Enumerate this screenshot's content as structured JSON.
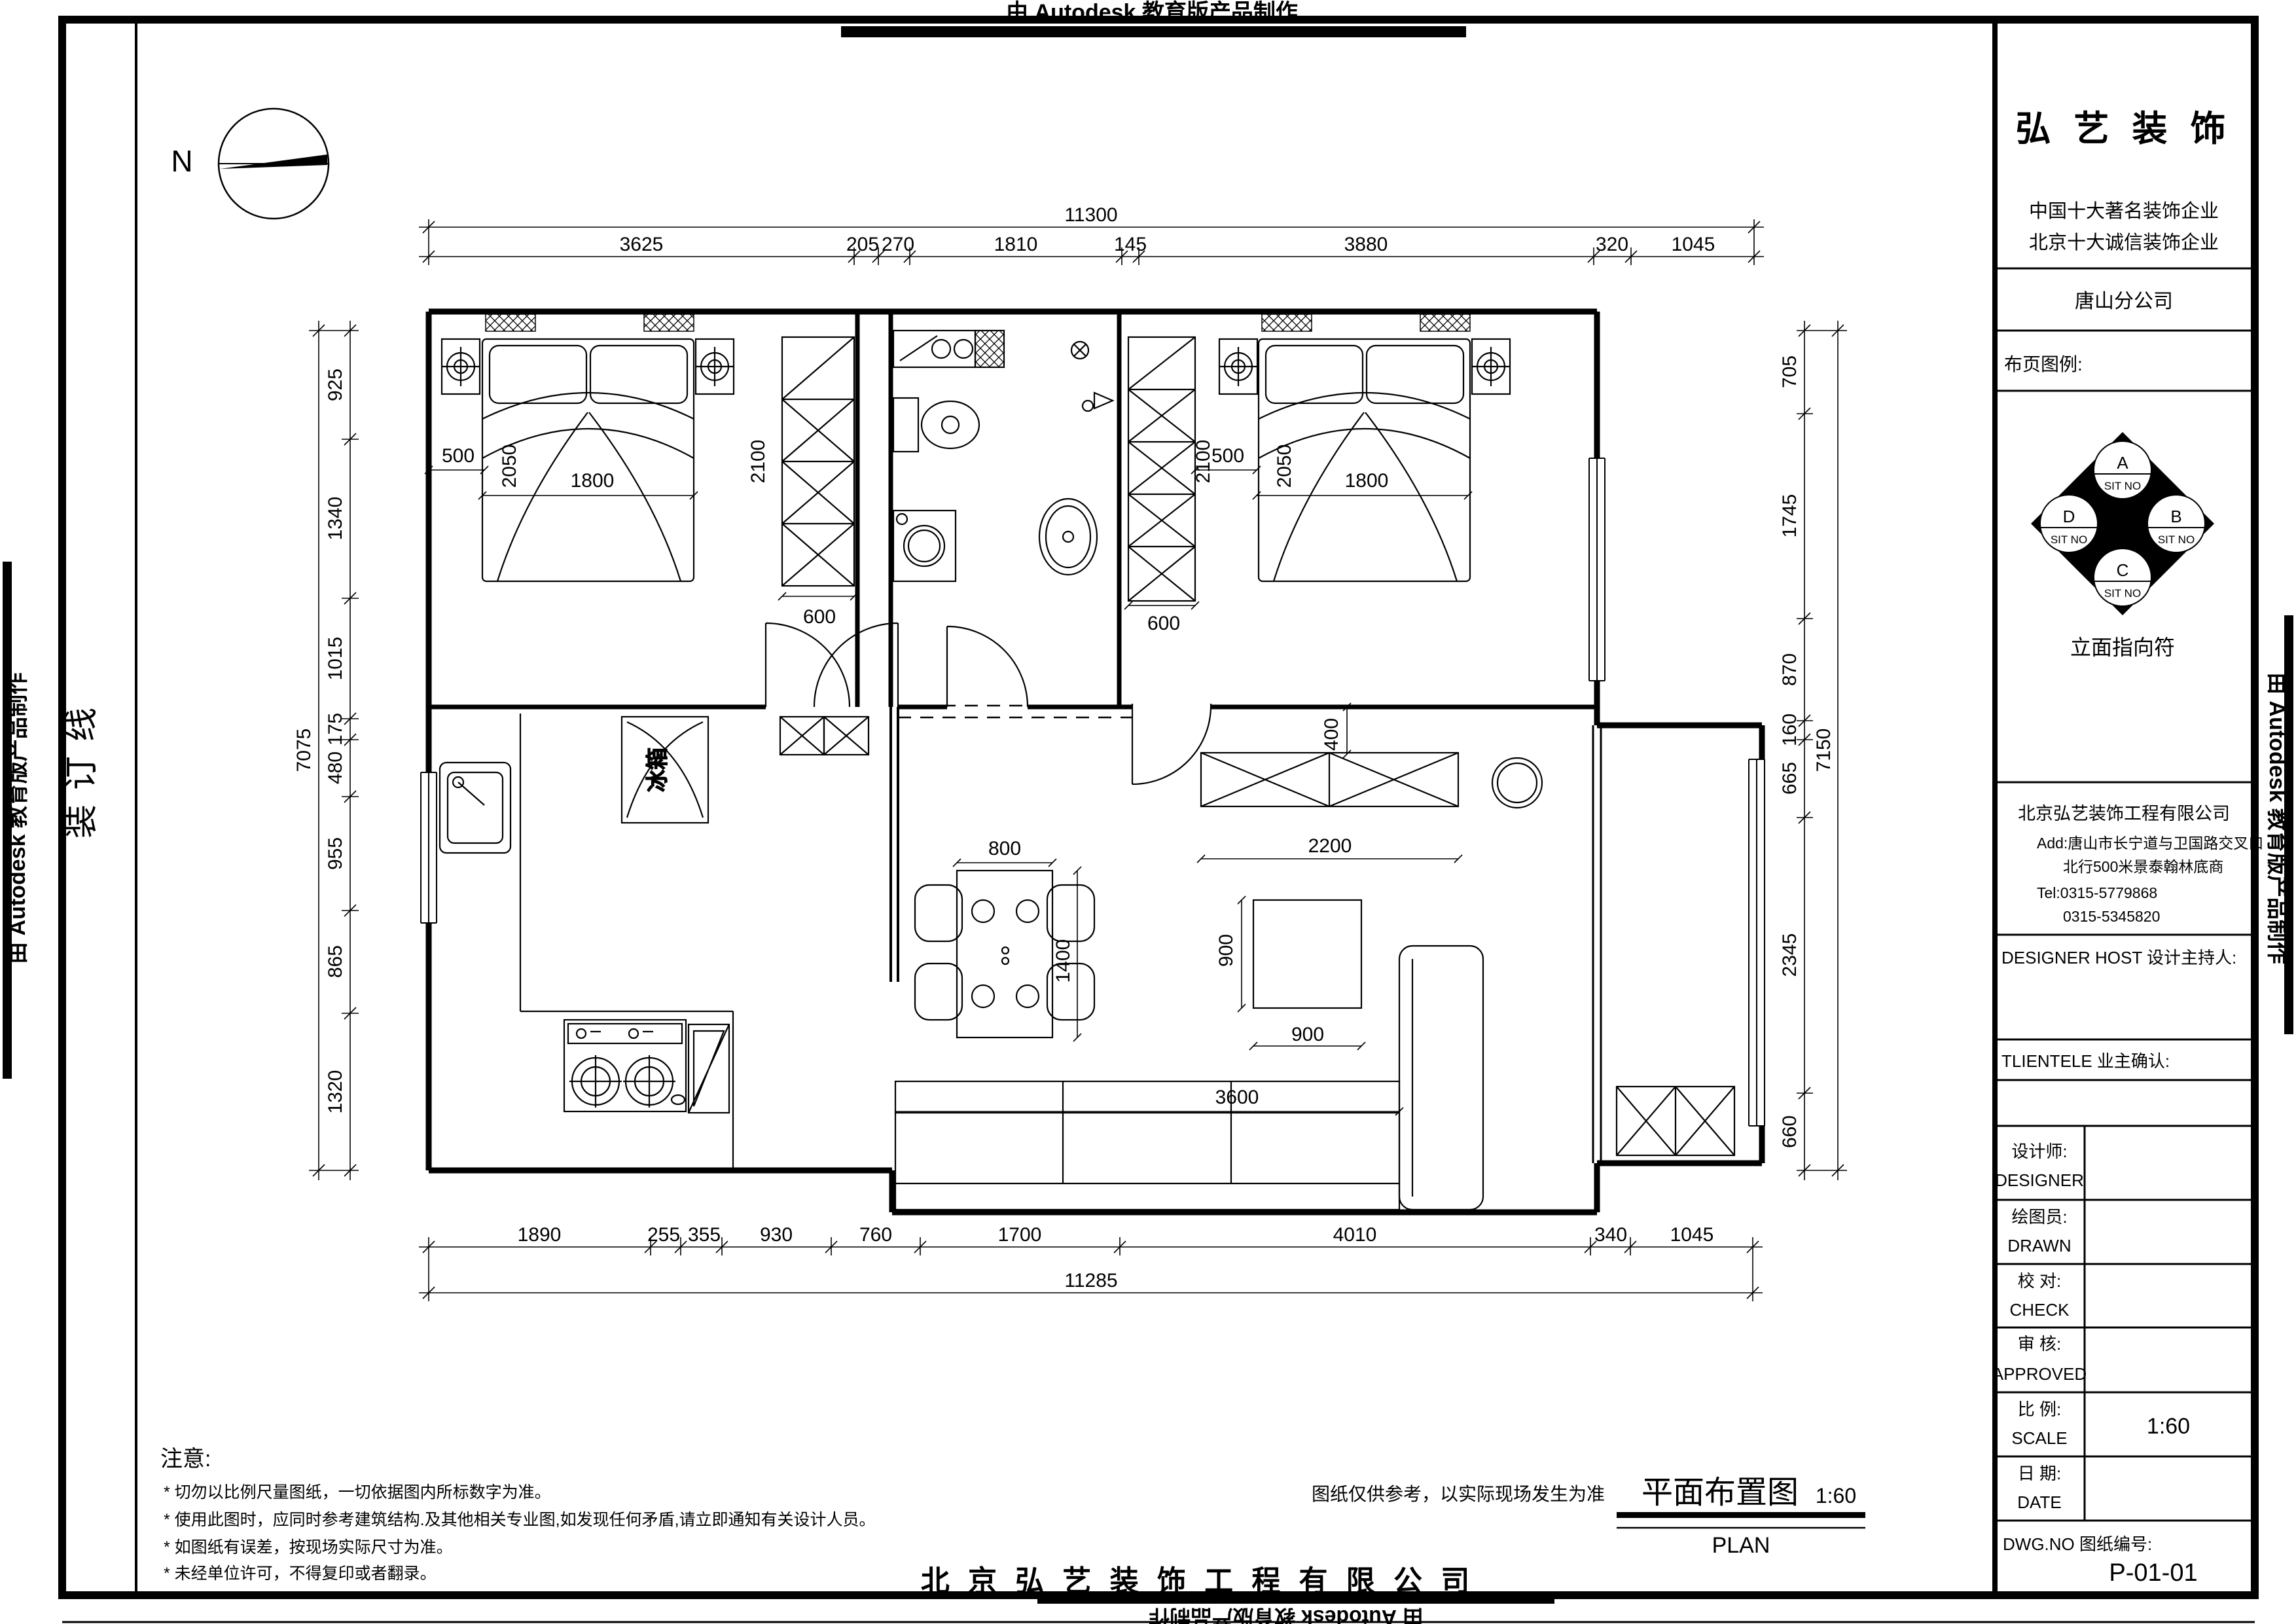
{
  "banner": {
    "text": "由 Autodesk 教育版产品制作"
  },
  "margins": {
    "binding_line": "装订线"
  },
  "compass": {
    "north": "N"
  },
  "title_block": {
    "logo": "弘 艺 装 饰",
    "slogan1": "中国十大著名装饰企业",
    "slogan2": "北京十大诚信装饰企业",
    "branch": "唐山分公司",
    "legend_label": "布页图例:",
    "legend": {
      "a": "A",
      "b": "B",
      "c": "C",
      "d": "D",
      "sit_no": "SIT NO",
      "caption": "立面指向符"
    },
    "company": "北京弘艺装饰工程有限公司",
    "address1": "Add:唐山市长宁道与卫国路交叉口",
    "address2": "北行500米景泰翰林底商",
    "tel1": "Tel:0315-5779868",
    "tel2": "0315-5345820",
    "designer_host": "DESIGNER HOST    设计主持人:",
    "clientele": "TLIENTELE    业主确认:",
    "rows": [
      {
        "cn": "设计师:",
        "en": "DESIGNER",
        "value": ""
      },
      {
        "cn": "绘图员:",
        "en": "DRAWN",
        "value": ""
      },
      {
        "cn": "校  对:",
        "en": "CHECK",
        "value": ""
      },
      {
        "cn": "审  核:",
        "en": "APPROVED",
        "value": ""
      },
      {
        "cn": "比  例:",
        "en": "SCALE",
        "value": "1:60"
      },
      {
        "cn": "日  期:",
        "en": "DATE",
        "value": ""
      }
    ],
    "dwg_label": "DWG.NO   图纸编号:",
    "dwg_no": "P-01-01"
  },
  "notes": {
    "heading": "注意:",
    "items": [
      "*  切勿以比例尺量图纸，一切依据图内所标数字为准。",
      "*  使用此图时，应同时参考建筑结构.及其他相关专业图,如发现任何矛盾,请立即通知有关设计人员。",
      "*  如图纸有误差，按现场实际尺寸为准。",
      "*  未经单位许可，不得复印或者翻录。"
    ]
  },
  "footer": {
    "disclaimer": "图纸仅供参考，以实际现场发生为准",
    "plan_title": "平面布置图",
    "plan_scale": "1:60",
    "plan_en": "PLAN",
    "company_footer": "北 京 弘 艺 装 饰 工 程 有 限 公 司"
  },
  "plan": {
    "fridge": "冰箱"
  },
  "dims": {
    "top_total": "11300",
    "top": [
      "3625",
      "205",
      "270",
      "1810",
      "145",
      "3880",
      "320",
      "1045"
    ],
    "bottom": [
      "1890",
      "255",
      "355",
      "930",
      "760",
      "1700",
      "4010",
      "340",
      "1045"
    ],
    "bottom_total": "11285",
    "left": [
      "925",
      "1340",
      "1015",
      "175",
      "480",
      "955",
      "865",
      "1320"
    ],
    "left_total": "7075",
    "right": [
      "705",
      "1745",
      "870",
      "160",
      "665",
      "2345",
      "660"
    ],
    "right_total": "7150",
    "nightstand_left": "500",
    "bed_left_l": "2050",
    "bed_left_w": "1800",
    "wardrobe_left_l": "2100",
    "wardrobe_left_w": "600",
    "nightstand_right": "500",
    "bed_right_l": "2050",
    "bed_right_w": "1800",
    "wardrobe_right_l": "2100",
    "wardrobe_right_w": "600",
    "dining_w": "800",
    "dining_l": "1400",
    "tv_w": "2200",
    "tv_offset": "400",
    "table_w": "900",
    "table_h": "900",
    "sofa_w": "3600"
  }
}
